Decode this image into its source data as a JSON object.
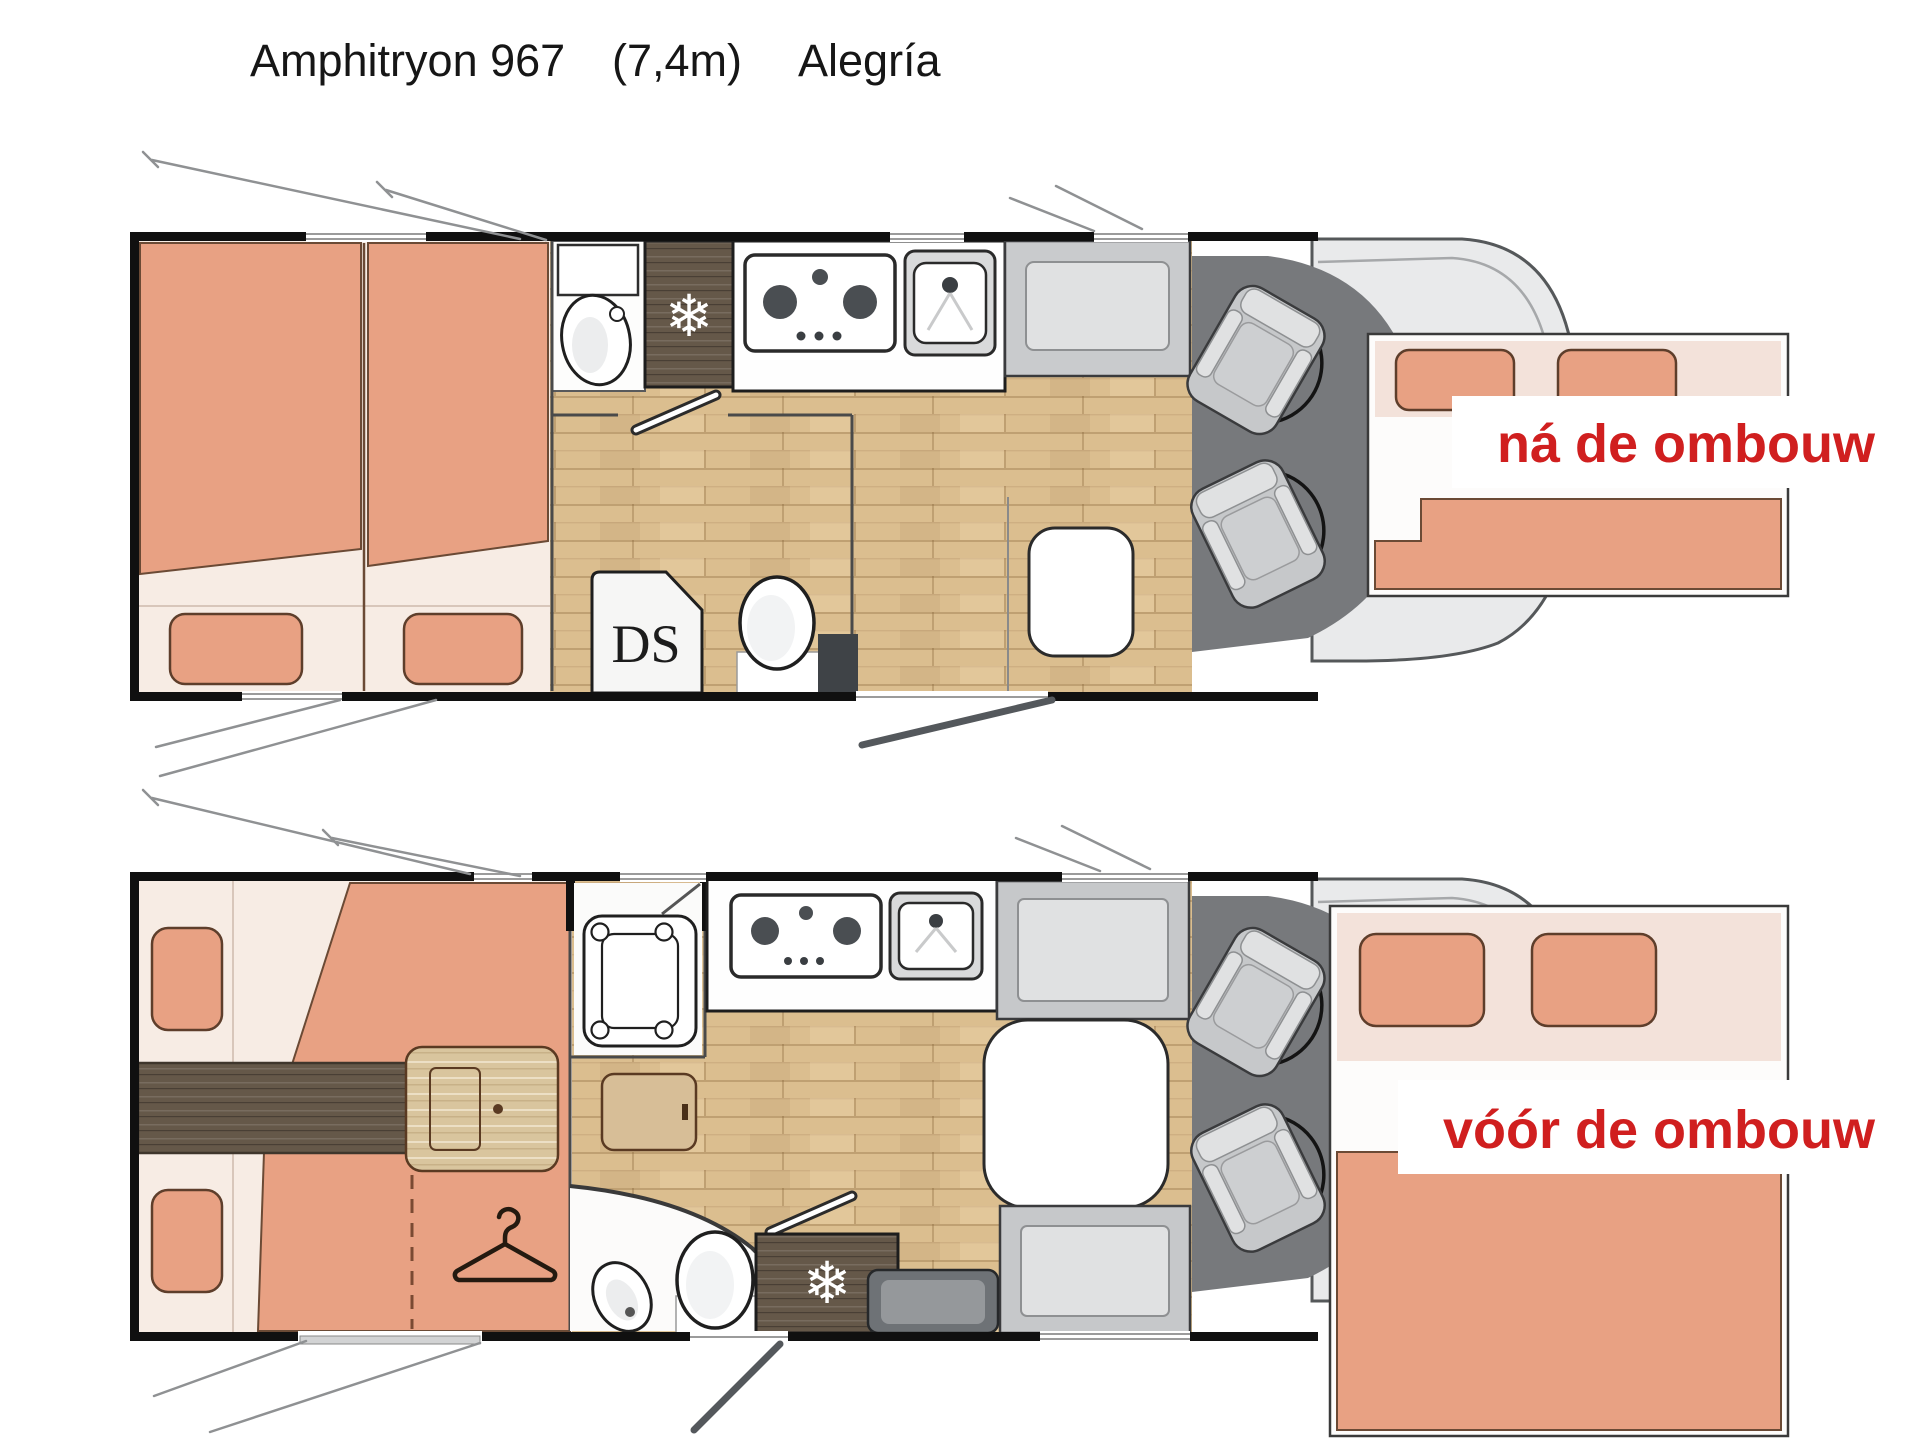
{
  "page": {
    "title_model": "Amphitryon 967",
    "title_length": "(7,4m)",
    "title_name": "Alegría"
  },
  "plans": {
    "after": {
      "label": "ná de ombouw",
      "position": "top"
    },
    "before": {
      "label": "vóór de ombouw",
      "position": "bottom"
    }
  },
  "annotations": {
    "ds_cabinet": "DS"
  },
  "icons": {
    "snowflake": "❄"
  },
  "colors": {
    "accent_red": "#D01F1F",
    "mattress_salmon": "#E8A183",
    "bedding_cream": "#F7ECE4",
    "wood_floor": "#DBBE8F",
    "dark_wood": "#655849",
    "tan_wood": "#D9C59E",
    "cab_gray": "#77797C",
    "body_gray": "#E9EAEB",
    "wall_black": "#101010"
  }
}
